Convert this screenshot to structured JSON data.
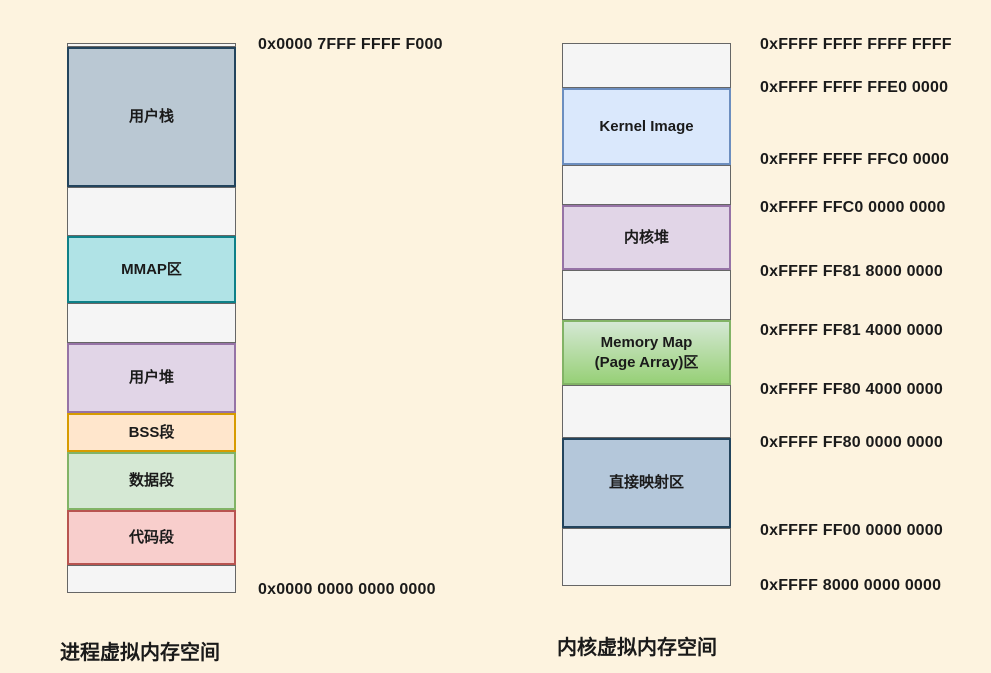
{
  "background_color": "#FDF3DF",
  "text_color": "#1A1A1A",
  "left_diagram": {
    "title": "进程虚拟内存空间",
    "top_address": "0x0000 7FFF FFFF F000",
    "bottom_address": "0x0000 0000 0000 0000",
    "segments": [
      {
        "name": "top-gap",
        "label": "",
        "fill": "#F5F5F5",
        "stroke": "#666666",
        "height": 4
      },
      {
        "name": "user-stack",
        "label": "用户栈",
        "fill": "#BAC8D3",
        "stroke": "#23445D",
        "height": 140
      },
      {
        "name": "free-gap-1",
        "label": "",
        "fill": "#F5F5F5",
        "stroke": "#666666",
        "height": 49
      },
      {
        "name": "mmap-area",
        "label": "MMAP区",
        "fill": "#B0E3E6",
        "stroke": "#0E8088",
        "height": 67
      },
      {
        "name": "free-gap-2",
        "label": "",
        "fill": "#F5F5F5",
        "stroke": "#666666",
        "height": 40
      },
      {
        "name": "user-heap",
        "label": "用户堆",
        "fill": "#E1D5E7",
        "stroke": "#9673A6",
        "height": 70
      },
      {
        "name": "bss-segment",
        "label": "BSS段",
        "fill": "#FFE6CC",
        "stroke": "#D79B00",
        "height": 39
      },
      {
        "name": "data-segment",
        "label": "数据段",
        "fill": "#D5E8D4",
        "stroke": "#82B366",
        "height": 58
      },
      {
        "name": "code-segment",
        "label": "代码段",
        "fill": "#F8CECC",
        "stroke": "#B85450",
        "height": 55
      },
      {
        "name": "bottom-gap",
        "label": "",
        "fill": "#F5F5F5",
        "stroke": "#666666",
        "height": 28
      }
    ]
  },
  "right_diagram": {
    "title": "内核虚拟内存空间",
    "segments": [
      {
        "name": "top-gap",
        "label": "",
        "fill": "#F5F5F5",
        "stroke": "#666666",
        "height": 45
      },
      {
        "name": "kernel-image",
        "label": "Kernel Image",
        "fill": "#DAE8FC",
        "stroke": "#6C8EBF",
        "height": 77
      },
      {
        "name": "free-gap-1",
        "label": "",
        "fill": "#F5F5F5",
        "stroke": "#666666",
        "height": 40
      },
      {
        "name": "kernel-heap",
        "label": "内核堆",
        "fill": "#E1D5E7",
        "stroke": "#9673A6",
        "height": 65
      },
      {
        "name": "free-gap-2",
        "label": "",
        "fill": "#F5F5F5",
        "stroke": "#666666",
        "height": 50
      },
      {
        "name": "memory-map-area",
        "label": "Memory Map\n(Page Array)区",
        "fill": "#D5E8D4",
        "fill2": "#97D077",
        "stroke": "#82B366",
        "height": 65
      },
      {
        "name": "free-gap-3",
        "label": "",
        "fill": "#F5F5F5",
        "stroke": "#666666",
        "height": 53
      },
      {
        "name": "direct-mapping-area",
        "label": "直接映射区",
        "fill": "#B4C7DA",
        "stroke": "#23445D",
        "height": 90
      },
      {
        "name": "bottom-gap",
        "label": "",
        "fill": "#F5F5F5",
        "stroke": "#666666",
        "height": 58
      }
    ],
    "addresses": [
      {
        "label": "0xFFFF FFFF FFFF FFFF",
        "y": 36
      },
      {
        "label": "0xFFFF FFFF FFE0 0000",
        "y": 79
      },
      {
        "label": "0xFFFF FFFF FFC0 0000",
        "y": 151
      },
      {
        "label": "0xFFFF FFC0 0000 0000",
        "y": 199
      },
      {
        "label": "0xFFFF FF81 8000 0000",
        "y": 263
      },
      {
        "label": "0xFFFF FF81 4000 0000",
        "y": 322
      },
      {
        "label": "0xFFFF FF80 4000 0000",
        "y": 381
      },
      {
        "label": "0xFFFF FF80 0000 0000",
        "y": 434
      },
      {
        "label": "0xFFFF FF00 0000 0000",
        "y": 522
      },
      {
        "label": "0xFFFF 8000 0000 0000",
        "y": 577
      }
    ]
  }
}
